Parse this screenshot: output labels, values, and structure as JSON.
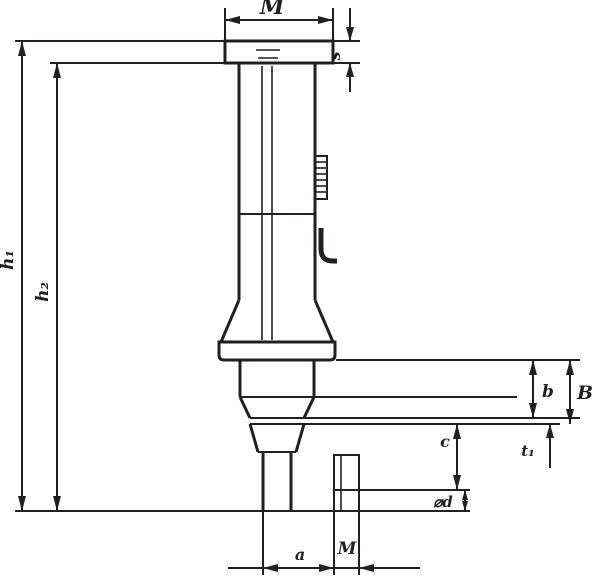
{
  "drawing": {
    "kind": "technical dimension drawing",
    "ink_color": "#231f20",
    "background_color": "#ffffff",
    "labels": {
      "width_top": "M",
      "cap_thickness": "s",
      "height_overall": "h₁",
      "height_body": "h₂",
      "step_depth_inner": "b",
      "step_depth_outer": "B",
      "flange_thickness": "t₁",
      "cone_length": "c",
      "tip_diameter": "⌀d",
      "tip_offset": "a",
      "thread_size": "M"
    }
  }
}
